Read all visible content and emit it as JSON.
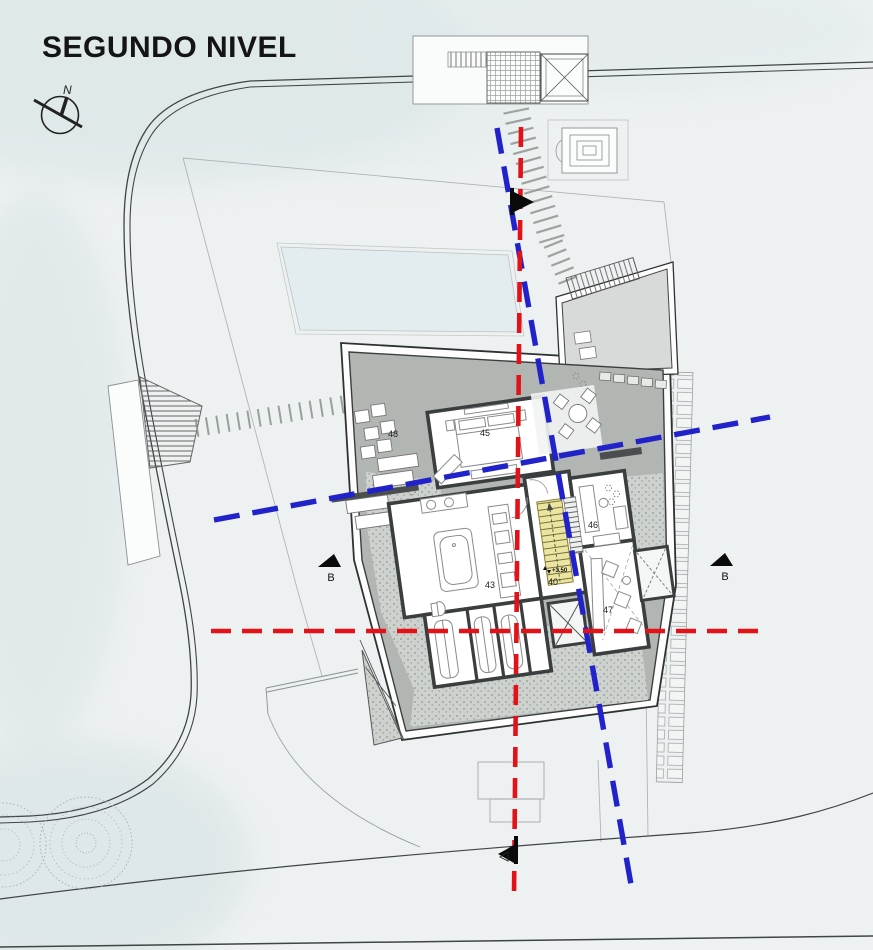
{
  "title": "SEGUNDO NIVEL",
  "compass": {
    "north_label": "N"
  },
  "sections": {
    "b_left": "B",
    "b_right": "B"
  },
  "plan": {
    "rooms": [
      {
        "number": "48"
      },
      {
        "number": "45"
      },
      {
        "number": "43"
      },
      {
        "number": "40"
      },
      {
        "number": "46"
      },
      {
        "number": "47"
      }
    ],
    "level_marker": "+3.50"
  },
  "colors": {
    "section_red": "#e31219",
    "section_blue": "#2222cb",
    "stair_highlight": "#ece5a2",
    "roof_gray": "#b2b6b3"
  }
}
